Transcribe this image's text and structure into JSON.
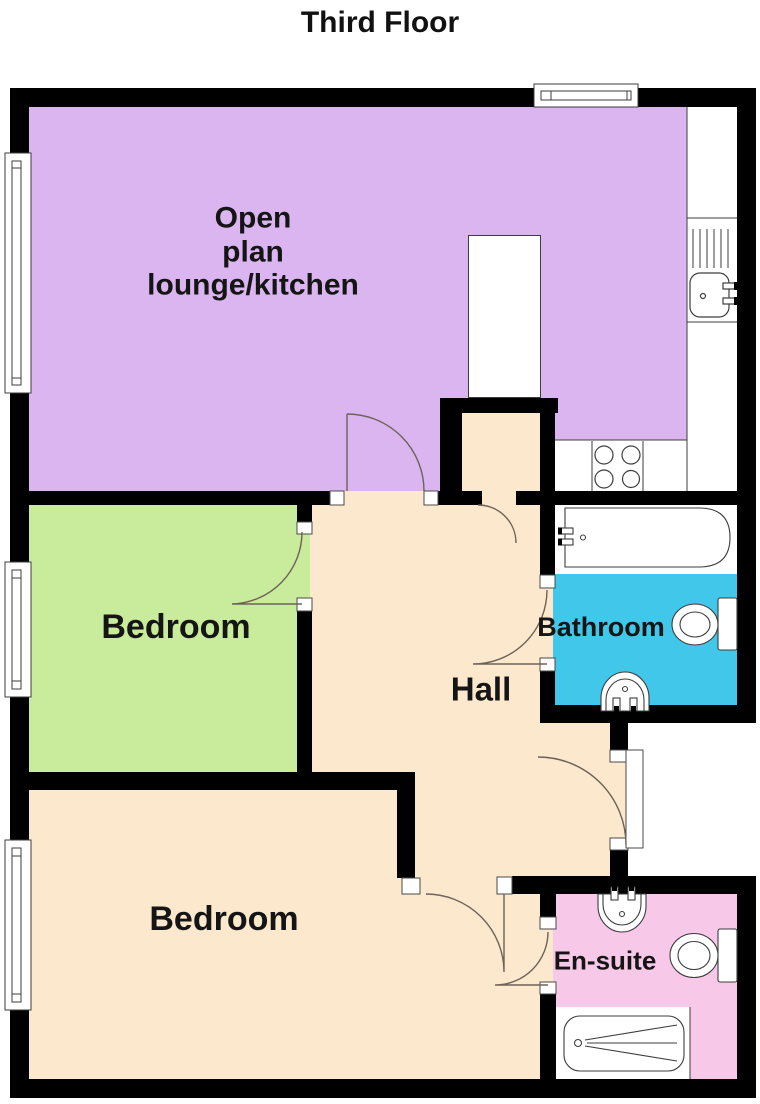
{
  "title": "Third Floor",
  "rooms": {
    "lounge": {
      "line1": "Open",
      "line2": "plan",
      "line3": "lounge/kitchen"
    },
    "bedroom1": {
      "label": "Bedroom"
    },
    "bedroom2": {
      "label": "Bedroom"
    },
    "hall": {
      "label": "Hall"
    },
    "bathroom": {
      "label": "Bathroom"
    },
    "ensuite": {
      "label": "En-suite"
    }
  },
  "colors": {
    "lounge": "#dab5f0",
    "bedroom": "#c9eb9c",
    "floor": "#fce8cd",
    "bathroom": "#41c7e9",
    "ensuite": "#f8c8e8",
    "wall": "#000000"
  },
  "fixtures": [
    "kitchen-sink",
    "drainer",
    "hob",
    "kitchen-island",
    "bathtub",
    "toilet",
    "wash-basin",
    "ensuite-basin",
    "ensuite-toilet",
    "ensuite-bathtub",
    "windows",
    "door-swings",
    "entrance-door"
  ]
}
